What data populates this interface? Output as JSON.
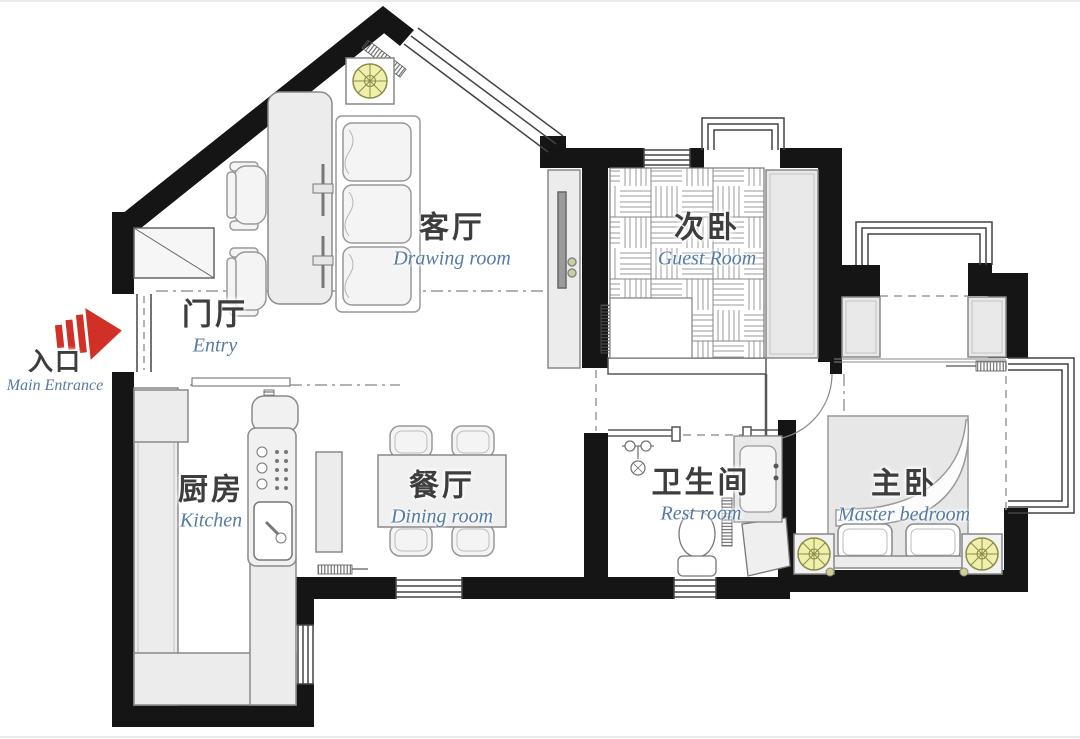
{
  "plan_title": "apartment-floor-plan",
  "colors": {
    "wall_black": "#151515",
    "label_cn": "#3d3d3d",
    "label_blue": "#567ba4",
    "arrow_red": "#d03026",
    "light_yellow": "#f0f0ad",
    "light_stroke": "#8c8c4a",
    "furniture_gray": "#ececec"
  },
  "entrance": {
    "cn": "入口",
    "en": "Main Entrance"
  },
  "rooms": [
    {
      "id": "drawing-room",
      "cn": "客厅",
      "en": "Drawing room"
    },
    {
      "id": "entry",
      "cn": "门厅",
      "en": "Entry"
    },
    {
      "id": "kitchen",
      "cn": "厨房",
      "en": "Kitchen"
    },
    {
      "id": "dining-room",
      "cn": "餐厅",
      "en": "Dining room"
    },
    {
      "id": "guest-room",
      "cn": "次卧",
      "en": "Guest Room"
    },
    {
      "id": "rest-room",
      "cn": "卫生间",
      "en": "Rest room"
    },
    {
      "id": "master-bedroom",
      "cn": "主卧",
      "en": "Master bedroom"
    }
  ],
  "icons": {
    "entrance_arrow": "red-arrow-right",
    "ceiling_light": "round-ceiling-lamp"
  }
}
